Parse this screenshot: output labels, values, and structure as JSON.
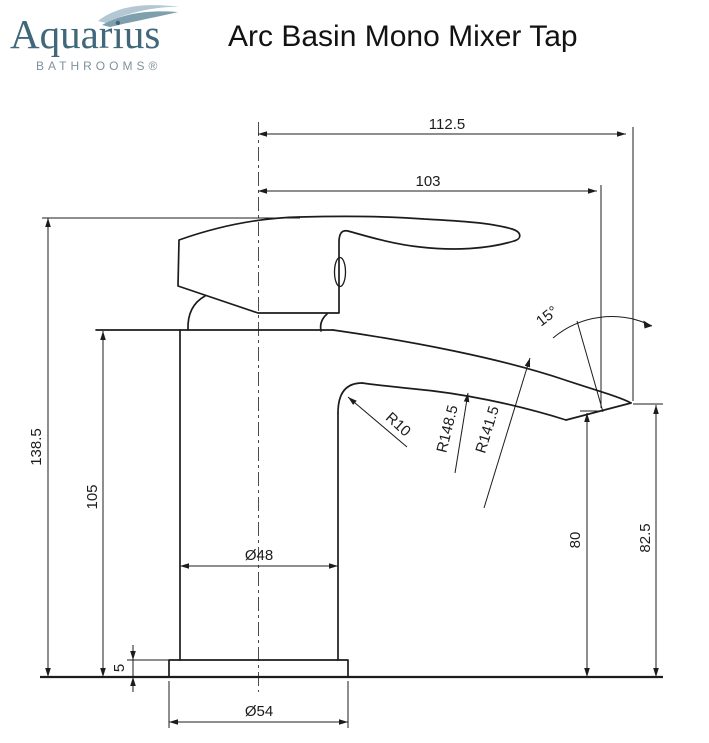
{
  "header": {
    "brand": "Aquarius",
    "brand_sub": "BATHROOMS®",
    "title": "Arc Basin Mono Mixer Tap"
  },
  "drawing": {
    "labels": {
      "overall_projection": "112.5",
      "spout_reach": "103",
      "overall_height": "138.5",
      "body_height": "105",
      "base_plate_height": "5",
      "body_diameter": "Ø48",
      "base_diameter": "Ø54",
      "outlet_height": "80",
      "spout_tip_height": "82.5",
      "spout_end_angle": "15°",
      "fillet_radius": "R10",
      "underside_radius": "R148.5",
      "topside_radius": "R141.5"
    }
  },
  "colors": {
    "line": "#1c1c1c",
    "brand_text": "#41687a",
    "brand_sub_text": "#7e919c",
    "wave_light": "#b3c8d2",
    "wave_dark": "#7e9fae",
    "background": "#ffffff"
  }
}
